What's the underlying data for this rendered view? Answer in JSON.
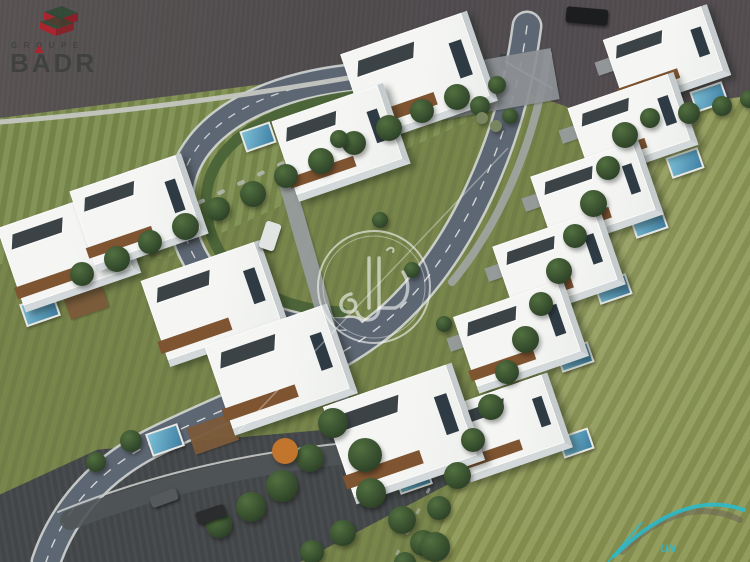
{
  "image": {
    "description": "Aerial 3D architectural rendering of a gated villa compound: white modern two-storey villas with wood accents and private pools, arranged along a looping internal road with entrance gate at top, surrounded by large striped lawns, perimeter trees and outer asphalt roads",
    "time_of_day": "late afternoon"
  },
  "branding": {
    "groupe_badr": {
      "groupe_label": "GROUPE",
      "badr_label": "BADR",
      "icon": "isometric-stacked-building-icon",
      "red": "rgba(185,30,40,0.85)",
      "green": "rgba(40,72,48,0.75)",
      "gray": "rgba(60,62,60,0.82)"
    },
    "watermark": {
      "arabic_text": "دوار",
      "shape": "double-circle-with-diagonal-line",
      "color": "rgba(248,250,248,0.6)"
    },
    "corner_logo": {
      "text": "UN",
      "swoosh_color": "#2cb9c9"
    }
  },
  "scene": {
    "colors": {
      "asphalt-top": "#4e4a4c",
      "asphalt-bottom": "#434648",
      "road": "#5d6673",
      "road-edge": "#d2d6d5",
      "grass-base": "#78854b",
      "grass-right": "#8a9551",
      "grass-topleft": "#7d8d4f",
      "tree-dark": "#31472a",
      "tree-mid": "#527040",
      "villa-white": "#edefed",
      "villa-shadow": "#c6cbce",
      "wood": "#7e5431",
      "slate": "#3c4347",
      "pool-light": "#7cc0d8",
      "pool-dark": "#3f7ea2",
      "hedge": "#4a6338",
      "pave": "#989da0",
      "deck": "#7c5a3a",
      "teal": "#2cb9c9",
      "logo-gray": "rgba(60,62,60,0.82)",
      "logo-red": "rgba(185,30,40,0.85)"
    },
    "villas": [
      {
        "x": 352,
        "y": 30,
        "w": 128,
        "h": 88
      },
      {
        "x": 282,
        "y": 100,
        "w": 112,
        "h": 78
      },
      {
        "x": 8,
        "y": 206,
        "w": 116,
        "h": 82
      },
      {
        "x": 80,
        "y": 170,
        "w": 112,
        "h": 78
      },
      {
        "x": 152,
        "y": 258,
        "w": 120,
        "h": 84
      },
      {
        "x": 216,
        "y": 322,
        "w": 124,
        "h": 88
      },
      {
        "x": 612,
        "y": 20,
        "w": 104,
        "h": 68
      },
      {
        "x": 577,
        "y": 88,
        "w": 106,
        "h": 70
      },
      {
        "x": 540,
        "y": 156,
        "w": 108,
        "h": 72
      },
      {
        "x": 502,
        "y": 226,
        "w": 108,
        "h": 72
      },
      {
        "x": 463,
        "y": 296,
        "w": 110,
        "h": 74
      },
      {
        "x": 455,
        "y": 388,
        "w": 102,
        "h": 72
      },
      {
        "x": 336,
        "y": 382,
        "w": 130,
        "h": 96
      }
    ],
    "pools": [
      {
        "x": 692,
        "y": 86,
        "w": 30,
        "h": 18
      },
      {
        "x": 668,
        "y": 152,
        "w": 30,
        "h": 18
      },
      {
        "x": 632,
        "y": 212,
        "w": 30,
        "h": 18
      },
      {
        "x": 596,
        "y": 278,
        "w": 30,
        "h": 18
      },
      {
        "x": 558,
        "y": 346,
        "w": 30,
        "h": 18
      },
      {
        "x": 560,
        "y": 432,
        "w": 28,
        "h": 18
      },
      {
        "x": 22,
        "y": 298,
        "w": 32,
        "h": 20
      },
      {
        "x": 148,
        "y": 428,
        "w": 30,
        "h": 20
      },
      {
        "x": 396,
        "y": 466,
        "w": 30,
        "h": 20
      },
      {
        "x": 242,
        "y": 126,
        "w": 28,
        "h": 18
      }
    ],
    "paves": [
      {
        "x": 436,
        "y": 58,
        "w": 120,
        "h": 52,
        "r": -10,
        "c": "#8e9296"
      },
      {
        "x": 596,
        "y": 58,
        "w": 26,
        "h": 14
      },
      {
        "x": 560,
        "y": 126,
        "w": 26,
        "h": 14
      },
      {
        "x": 523,
        "y": 194,
        "w": 26,
        "h": 14
      },
      {
        "x": 486,
        "y": 264,
        "w": 26,
        "h": 14
      },
      {
        "x": 448,
        "y": 334,
        "w": 26,
        "h": 14
      },
      {
        "x": 298,
        "y": 170,
        "w": 16,
        "h": 160,
        "r": -16
      },
      {
        "x": 330,
        "y": 326,
        "w": 14,
        "h": 120,
        "r": -20
      }
    ],
    "decks": [
      {
        "x": 66,
        "y": 290,
        "w": 40,
        "h": 24
      },
      {
        "x": 190,
        "y": 420,
        "w": 46,
        "h": 28
      },
      {
        "x": 352,
        "y": 460,
        "w": 50,
        "h": 30
      }
    ],
    "trees": [
      {
        "x": 70,
        "y": 262,
        "s": 24
      },
      {
        "x": 104,
        "y": 246,
        "s": 26
      },
      {
        "x": 138,
        "y": 230,
        "s": 24
      },
      {
        "x": 172,
        "y": 213,
        "s": 27
      },
      {
        "x": 206,
        "y": 197,
        "s": 24
      },
      {
        "x": 240,
        "y": 181,
        "s": 26
      },
      {
        "x": 274,
        "y": 164,
        "s": 24
      },
      {
        "x": 308,
        "y": 148,
        "s": 26
      },
      {
        "x": 342,
        "y": 131,
        "s": 24
      },
      {
        "x": 376,
        "y": 115,
        "s": 26
      },
      {
        "x": 410,
        "y": 99,
        "s": 24
      },
      {
        "x": 444,
        "y": 84,
        "s": 26
      },
      {
        "x": 470,
        "y": 96,
        "s": 20
      },
      {
        "x": 488,
        "y": 76,
        "s": 18
      },
      {
        "x": 502,
        "y": 108,
        "s": 16
      },
      {
        "x": 476,
        "y": 112,
        "s": 12,
        "c": "#79855f"
      },
      {
        "x": 490,
        "y": 120,
        "s": 12,
        "c": "#79855f"
      },
      {
        "x": 612,
        "y": 122,
        "s": 26
      },
      {
        "x": 596,
        "y": 156,
        "s": 24
      },
      {
        "x": 580,
        "y": 190,
        "s": 27
      },
      {
        "x": 563,
        "y": 224,
        "s": 24
      },
      {
        "x": 546,
        "y": 258,
        "s": 26
      },
      {
        "x": 529,
        "y": 292,
        "s": 24
      },
      {
        "x": 512,
        "y": 326,
        "s": 27
      },
      {
        "x": 495,
        "y": 360,
        "s": 24
      },
      {
        "x": 478,
        "y": 394,
        "s": 26
      },
      {
        "x": 461,
        "y": 428,
        "s": 24
      },
      {
        "x": 444,
        "y": 462,
        "s": 27
      },
      {
        "x": 427,
        "y": 496,
        "s": 24
      },
      {
        "x": 410,
        "y": 530,
        "s": 26
      },
      {
        "x": 394,
        "y": 552,
        "s": 22
      },
      {
        "x": 640,
        "y": 108,
        "s": 20
      },
      {
        "x": 678,
        "y": 102,
        "s": 22
      },
      {
        "x": 712,
        "y": 96,
        "s": 20
      },
      {
        "x": 740,
        "y": 90,
        "s": 18
      },
      {
        "x": 318,
        "y": 408,
        "s": 30
      },
      {
        "x": 348,
        "y": 438,
        "s": 34
      },
      {
        "x": 296,
        "y": 444,
        "s": 28
      },
      {
        "x": 266,
        "y": 470,
        "s": 32
      },
      {
        "x": 236,
        "y": 492,
        "s": 30
      },
      {
        "x": 206,
        "y": 512,
        "s": 26
      },
      {
        "x": 356,
        "y": 478,
        "s": 30
      },
      {
        "x": 388,
        "y": 506,
        "s": 28
      },
      {
        "x": 420,
        "y": 532,
        "s": 30
      },
      {
        "x": 330,
        "y": 520,
        "s": 26
      },
      {
        "x": 300,
        "y": 540,
        "s": 24
      },
      {
        "x": 120,
        "y": 430,
        "s": 22
      },
      {
        "x": 86,
        "y": 452,
        "s": 20
      },
      {
        "x": 372,
        "y": 212,
        "s": 16
      },
      {
        "x": 404,
        "y": 262,
        "s": 16
      },
      {
        "x": 436,
        "y": 316,
        "s": 16
      },
      {
        "x": 330,
        "y": 130,
        "s": 18
      },
      {
        "x": 272,
        "y": 438,
        "s": 26,
        "c": "#c2752d"
      }
    ],
    "cars": [
      {
        "x": 566,
        "y": 8,
        "w": 42,
        "h": 16,
        "r": 5,
        "c": "#1b1d1f"
      },
      {
        "x": 262,
        "y": 222,
        "w": 16,
        "h": 28,
        "r": 18,
        "c": "#e2e4e3"
      },
      {
        "x": 196,
        "y": 508,
        "w": 30,
        "h": 13,
        "r": -18,
        "c": "#2a2c2e"
      },
      {
        "x": 150,
        "y": 492,
        "w": 28,
        "h": 12,
        "r": -20,
        "c": "#55595c"
      }
    ]
  }
}
